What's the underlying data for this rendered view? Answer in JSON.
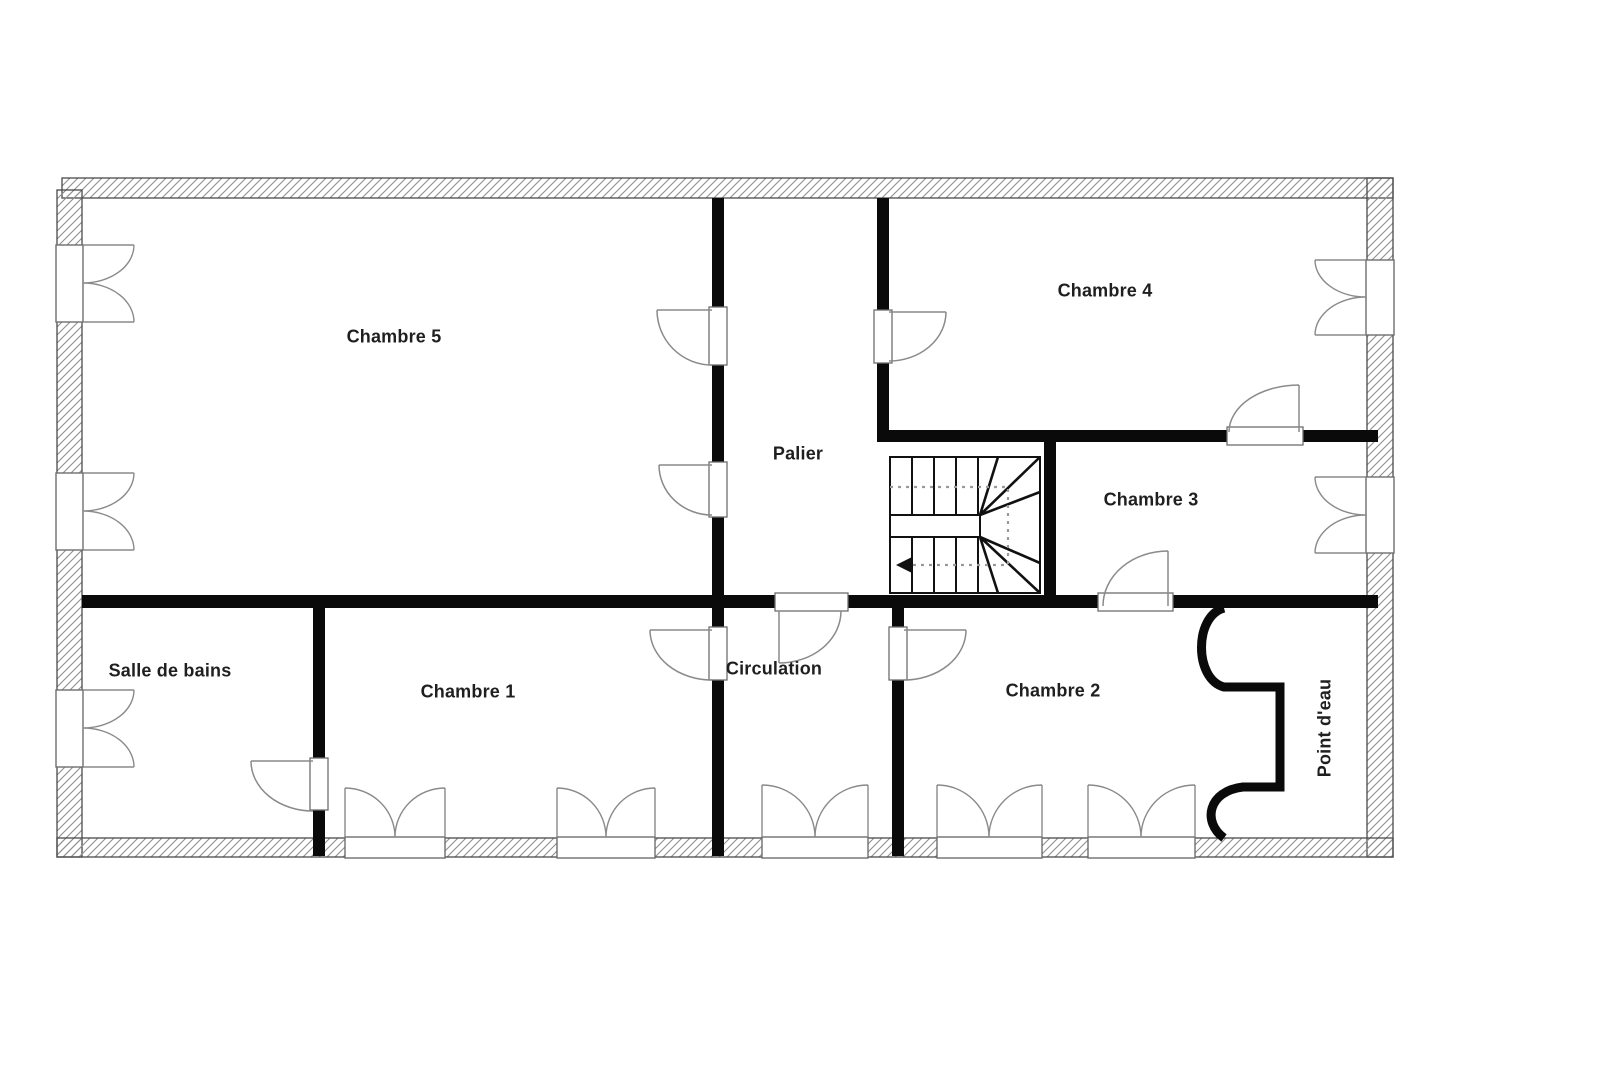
{
  "document": {
    "type": "floor-plan",
    "background": "#ffffff"
  },
  "rooms": [
    {
      "id": "chambre-5",
      "name": "Chambre 5"
    },
    {
      "id": "chambre-4",
      "name": "Chambre 4"
    },
    {
      "id": "palier",
      "name": "Palier"
    },
    {
      "id": "chambre-3",
      "name": "Chambre 3"
    },
    {
      "id": "salle-de-bains",
      "name": "Salle de bains"
    },
    {
      "id": "chambre-1",
      "name": "Chambre 1"
    },
    {
      "id": "circulation",
      "name": "Circulation"
    },
    {
      "id": "chambre-2",
      "name": "Chambre 2"
    },
    {
      "id": "point-d-eau",
      "name": "Point d'eau"
    }
  ],
  "colors": {
    "wall": "#0a0a0a",
    "exterior_wall_outline": "#4a4a4a",
    "hatch_line": "#8f8f8f",
    "symbol_line": "#6e6e6e",
    "stair_line": "#111111",
    "walkline_dotted": "#999999",
    "label_text": "#1f1f1f"
  }
}
